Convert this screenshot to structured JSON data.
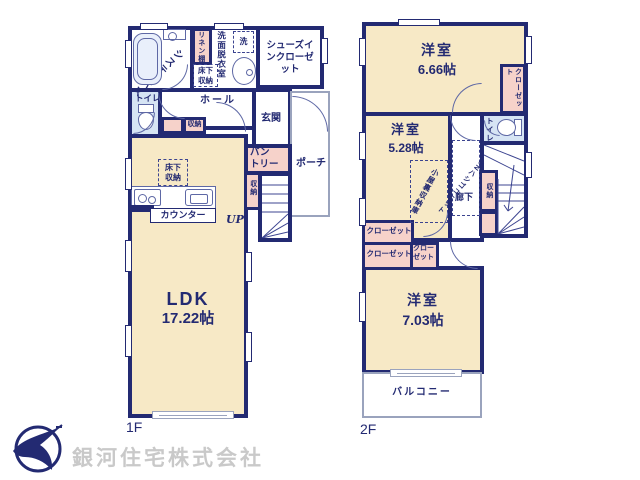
{
  "palette": {
    "wall": "#232a72",
    "room_fill": "#f7e9c6",
    "closet_fill": "#f6d2ca",
    "water_fill": "#d6e4f4",
    "line": "#5e68a5",
    "company_text": "#c9c9c9"
  },
  "floor1": {
    "floor_label": "1F",
    "bath": "システムバス",
    "linen": "リネン棚",
    "washroom": "洗面脱衣室",
    "washer": "洗",
    "underfloor_bath": "床下収納",
    "shoes_closet": "シューズインクローゼット",
    "toilet": "トイレ",
    "hall": "ホール",
    "hall_storage": "収納",
    "genkan": "玄関",
    "porch": "ポーチ",
    "pantry": "パントリー",
    "stairs_storage": "収納",
    "underfloor_kitchen": "床下収納",
    "counter": "カウンター",
    "up": "UP",
    "ldk_name": "LDK",
    "ldk_size": "17.22帖"
  },
  "floor2": {
    "floor_label": "2F",
    "room1_name": "洋室",
    "room1_size": "6.66帖",
    "closet_right": "クローゼット",
    "room2_name": "洋室",
    "room2_size": "5.28帖",
    "toilet": "トイレ",
    "corridor": "廊下",
    "ladder_unit": "DNハシゴユニット",
    "attic_storage": "小屋裏収納庫",
    "stairs_storage": "収納",
    "closet_a": "クローゼット",
    "closet_b": "クローゼット",
    "closet_c": "クローゼット",
    "room3_name": "洋室",
    "room3_size": "7.03帖",
    "balcony": "バルコニー"
  },
  "footer": {
    "company": "銀河住宅株式会社"
  }
}
